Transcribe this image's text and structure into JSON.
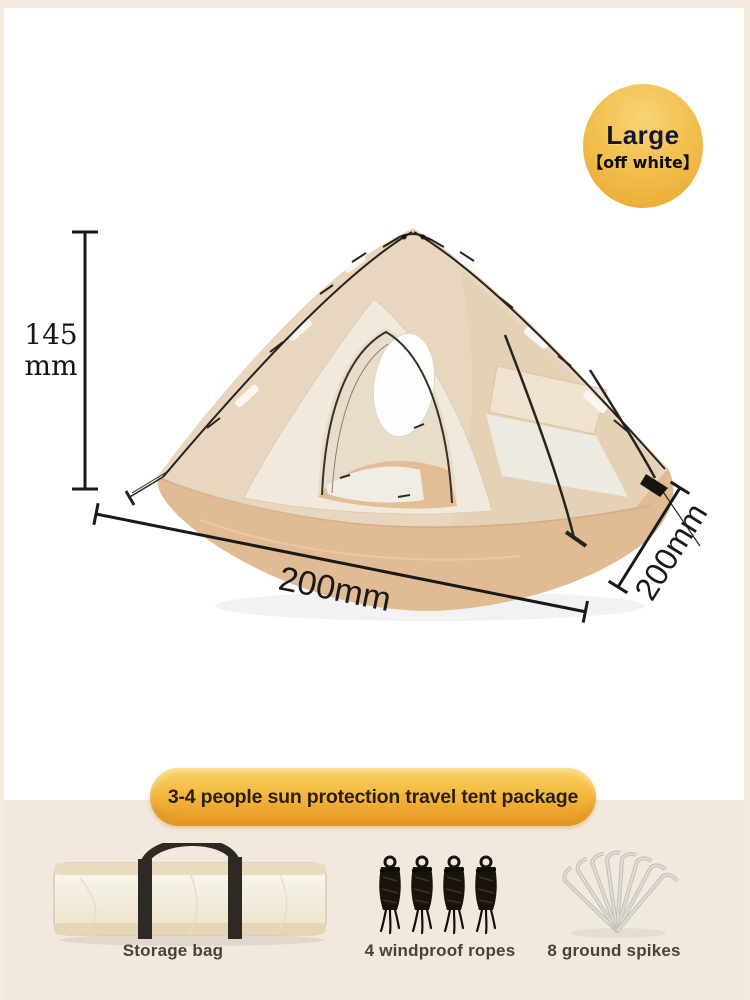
{
  "badge": {
    "size": "Large",
    "variant": "【off white】"
  },
  "tent": {
    "height": {
      "value": "145",
      "unit": "mm"
    },
    "width_label": "200mm",
    "depth_label": "200mm"
  },
  "banner": {
    "title": "3-4 people sun protection travel tent package"
  },
  "package": {
    "items": [
      {
        "name": "Storage bag"
      },
      {
        "name": "4 windproof ropes"
      },
      {
        "name": "8 ground spikes"
      }
    ]
  },
  "colors": {
    "accent_gold": "#f2bf4e",
    "fly_beige": "#e9d6be",
    "floor_tan": "#e0bb93",
    "background_cream": "#f2e9de",
    "line_black": "#191919"
  }
}
